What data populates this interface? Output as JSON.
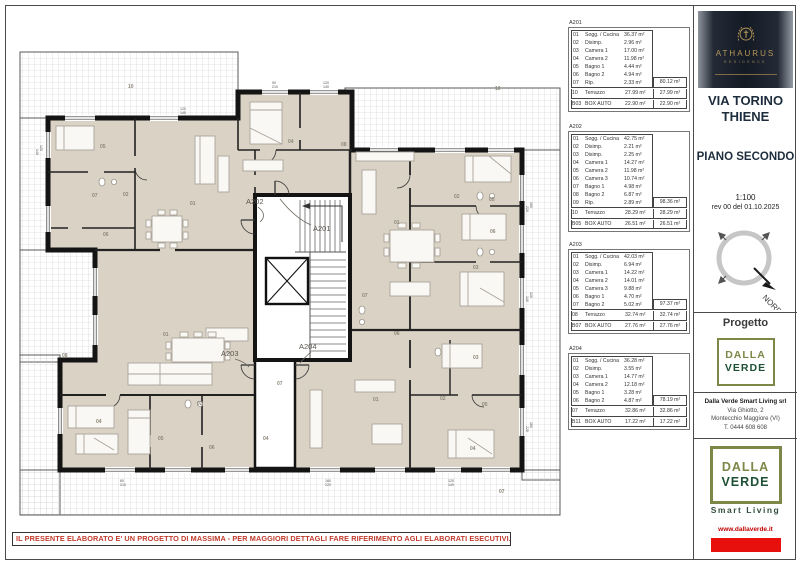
{
  "page": {
    "disclaimer": "IL PRESENTE ELABORATO E' UN PROGETTO DI MASSIMA - PER MAGGIORI DETTAGLI FARE RIFERIMENTO AGLI ELABORATI ESECUTIVI."
  },
  "title_block": {
    "brand_name": "ATHAURUS",
    "brand_sub": "RESIDENCE",
    "project_title_line1": "VIA TORINO",
    "project_title_line2": "THIENE",
    "drawing_title": "PIANO SECONDO",
    "scale": "1:100",
    "revision": "rev  00  del  01.10.2025",
    "north_label": "NORD",
    "progetto_label": "Progetto",
    "logo_word1": "DALLA",
    "logo_word2": "VERDE",
    "company_line1": "Dalla Verde Smart Living srl",
    "company_line2": "Via Ghiotto, 2",
    "company_line3": "Montecchio Maggiore (VI)",
    "company_line4": "T. 0444 608 608",
    "smart_living": "Smart Living",
    "website": "www.dallaverde.it",
    "accent_red": "#e8100c",
    "logo_olive": "#7c8748",
    "logo_green": "#1f5136",
    "gold": "#b6975a"
  },
  "tables": [
    {
      "id": "A201",
      "rooms": [
        {
          "code": "01",
          "name": "Sogg. / Cucina",
          "value": "36.37 m²"
        },
        {
          "code": "02",
          "name": "Disimp.",
          "value": "2.96 m²"
        },
        {
          "code": "03",
          "name": "Camera 1",
          "value": "17.00 m²"
        },
        {
          "code": "04",
          "name": "Camera 2",
          "value": "11.98 m²"
        },
        {
          "code": "05",
          "name": "Bagno 1",
          "value": "4.44 m²"
        },
        {
          "code": "06",
          "name": "Bagno 2",
          "value": "4.94 m²"
        },
        {
          "code": "07",
          "name": "Rip.",
          "value": "2.33 m²"
        }
      ],
      "subtotal": "80.12 m²",
      "extras": [
        {
          "code": "10",
          "name": "Terrazzo",
          "value": "27.99 m²",
          "total": "27.99 m²"
        },
        {
          "code": "B03",
          "name": "BOX AUTO",
          "value": "22.90 m²",
          "total": "22.90 m²"
        }
      ]
    },
    {
      "id": "A202",
      "rooms": [
        {
          "code": "01",
          "name": "Sogg. / Cucina",
          "value": "42.75 m²"
        },
        {
          "code": "02",
          "name": "Disimp.",
          "value": "2.21 m²"
        },
        {
          "code": "03",
          "name": "Disimp.",
          "value": "2.25 m²"
        },
        {
          "code": "04",
          "name": "Camera 1",
          "value": "14.27 m²"
        },
        {
          "code": "05",
          "name": "Camera 2",
          "value": "11.98 m²"
        },
        {
          "code": "06",
          "name": "Camera 3",
          "value": "10.74 m²"
        },
        {
          "code": "07",
          "name": "Bagno 1",
          "value": "4.98 m²"
        },
        {
          "code": "08",
          "name": "Bagno 2",
          "value": "6.87 m²"
        },
        {
          "code": "09",
          "name": "Rip.",
          "value": "2.89 m²"
        }
      ],
      "subtotal": "98.36 m²",
      "extras": [
        {
          "code": "10",
          "name": "Terrazzo",
          "value": "28.29 m²",
          "total": "28.29 m²"
        },
        {
          "code": "B05",
          "name": "BOX AUTO",
          "value": "26.51 m²",
          "total": "26.51 m²"
        }
      ]
    },
    {
      "id": "A203",
      "rooms": [
        {
          "code": "01",
          "name": "Sogg. / Cucina",
          "value": "42.03 m²"
        },
        {
          "code": "02",
          "name": "Disimp.",
          "value": "6.94 m²"
        },
        {
          "code": "03",
          "name": "Camera 1",
          "value": "14.22 m²"
        },
        {
          "code": "04",
          "name": "Camera 2",
          "value": "14.01 m²"
        },
        {
          "code": "05",
          "name": "Camera 3",
          "value": "9.88 m²"
        },
        {
          "code": "06",
          "name": "Bagno 1",
          "value": "4.70 m²"
        },
        {
          "code": "07",
          "name": "Bagno 2",
          "value": "5.02 m²"
        }
      ],
      "subtotal": "97.37 m²",
      "extras": [
        {
          "code": "08",
          "name": "Terrazzo",
          "value": "32.74 m²",
          "total": "32.74 m²"
        },
        {
          "code": "B07",
          "name": "BOX AUTO",
          "value": "27.76 m²",
          "total": "27.76 m²"
        }
      ]
    },
    {
      "id": "A204",
      "rooms": [
        {
          "code": "01",
          "name": "Sogg. / Cucina",
          "value": "36.28 m²"
        },
        {
          "code": "02",
          "name": "Disimp.",
          "value": "3.55 m²"
        },
        {
          "code": "03",
          "name": "Camera 1",
          "value": "14.77 m²"
        },
        {
          "code": "04",
          "name": "Camera 2",
          "value": "12.18 m²"
        },
        {
          "code": "05",
          "name": "Bagno 1",
          "value": "3.28 m²"
        },
        {
          "code": "06",
          "name": "Bagno 2",
          "value": "4.87 m²"
        }
      ],
      "subtotal": "78.19 m²",
      "extras": [
        {
          "code": "07",
          "name": "Terrazzo",
          "value": "32.86 m²",
          "total": "32.86 m²"
        },
        {
          "code": "B11",
          "name": "BOX AUTO",
          "value": "17.22 m²",
          "total": "17.22 m²"
        }
      ]
    }
  ],
  "plan": {
    "units": [
      {
        "t": "A202",
        "x": 236,
        "y": 194
      },
      {
        "t": "A201",
        "x": 303,
        "y": 221
      },
      {
        "t": "A203",
        "x": 211,
        "y": 346
      },
      {
        "t": "A204",
        "x": 289,
        "y": 339
      }
    ],
    "rooms": [
      {
        "t": "10",
        "x": 118,
        "y": 78
      },
      {
        "t": "04",
        "x": 278,
        "y": 133
      },
      {
        "t": "08",
        "x": 331,
        "y": 136
      },
      {
        "t": "10",
        "x": 485,
        "y": 80
      },
      {
        "t": "05",
        "x": 90,
        "y": 138
      },
      {
        "t": "01",
        "x": 180,
        "y": 195
      },
      {
        "t": "07",
        "x": 82,
        "y": 187
      },
      {
        "t": "02",
        "x": 113,
        "y": 186
      },
      {
        "t": "06",
        "x": 93,
        "y": 226
      },
      {
        "t": "02",
        "x": 444,
        "y": 188
      },
      {
        "t": "05",
        "x": 479,
        "y": 191
      },
      {
        "t": "06",
        "x": 480,
        "y": 223
      },
      {
        "t": "01",
        "x": 384,
        "y": 214
      },
      {
        "t": "03",
        "x": 463,
        "y": 259
      },
      {
        "t": "07",
        "x": 352,
        "y": 287
      },
      {
        "t": "08",
        "x": 52,
        "y": 347
      },
      {
        "t": "01",
        "x": 153,
        "y": 326
      },
      {
        "t": "02",
        "x": 187,
        "y": 395
      },
      {
        "t": "04",
        "x": 86,
        "y": 413
      },
      {
        "t": "05",
        "x": 148,
        "y": 430
      },
      {
        "t": "06",
        "x": 199,
        "y": 439
      },
      {
        "t": "07",
        "x": 267,
        "y": 375
      },
      {
        "t": "04",
        "x": 253,
        "y": 430
      },
      {
        "t": "01",
        "x": 363,
        "y": 391
      },
      {
        "t": "02",
        "x": 430,
        "y": 390
      },
      {
        "t": "05",
        "x": 472,
        "y": 396
      },
      {
        "t": "04",
        "x": 460,
        "y": 440
      },
      {
        "t": "06",
        "x": 384,
        "y": 325
      },
      {
        "t": "03",
        "x": 463,
        "y": 349
      },
      {
        "t": "07",
        "x": 489,
        "y": 483
      }
    ],
    "dims": [
      {
        "a": "120",
        "b": "140",
        "x": 170,
        "y": 100,
        "r": 0
      },
      {
        "a": "90",
        "b": "210",
        "x": 262,
        "y": 74,
        "r": 0
      },
      {
        "a": "120",
        "b": "140",
        "x": 313,
        "y": 74,
        "r": 0
      },
      {
        "a": "160",
        "b": "220",
        "x": 520,
        "y": 192,
        "r": 90
      },
      {
        "a": "120",
        "b": "140",
        "x": 520,
        "y": 282,
        "r": 90
      },
      {
        "a": "160",
        "b": "220",
        "x": 520,
        "y": 412,
        "r": 90
      },
      {
        "a": "120",
        "b": "140",
        "x": 30,
        "y": 135,
        "r": 90
      },
      {
        "a": "80",
        "b": "210",
        "x": 110,
        "y": 472,
        "r": 0
      },
      {
        "a": "160",
        "b": "220",
        "x": 315,
        "y": 472,
        "r": 0
      },
      {
        "a": "120",
        "b": "140",
        "x": 438,
        "y": 472,
        "r": 0
      }
    ]
  }
}
